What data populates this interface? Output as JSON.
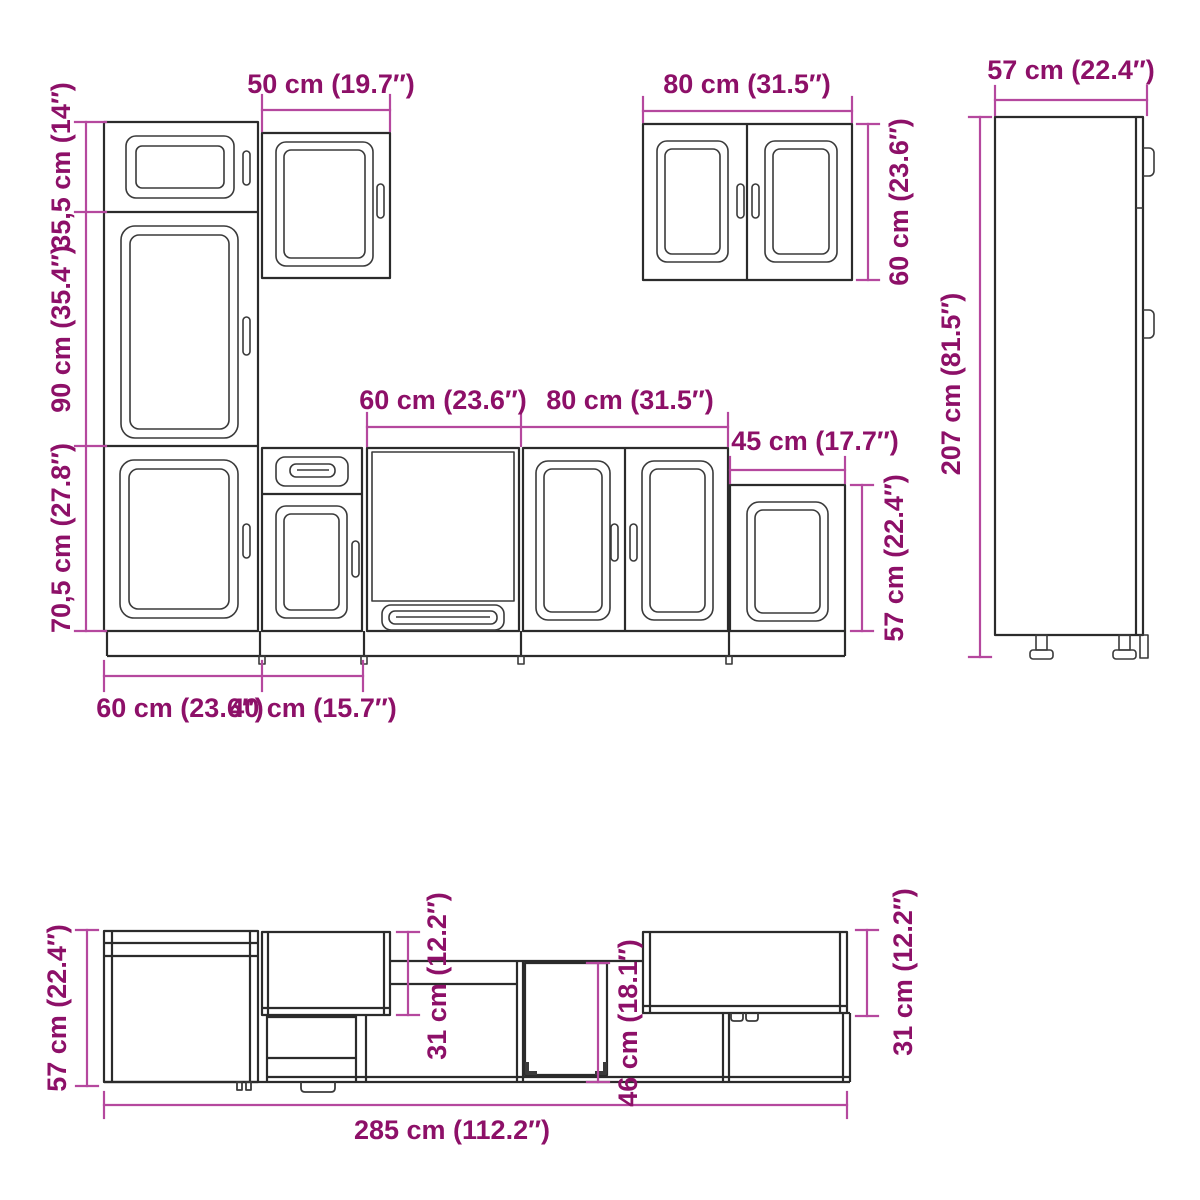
{
  "colors": {
    "outline": "#2b2b2b",
    "detail": "#3a3a3a",
    "dimension": "#b5489e",
    "label": "#8d1068",
    "background": "#ffffff"
  },
  "front_view": {
    "upper_section_height": "35,5 cm (14″)",
    "middle_section_height": "90 cm (35.4″)",
    "base_section_height": "70,5 cm (27.8″)",
    "wall_cabinet_50_width": "50 cm (19.7″)",
    "oven_cabinet_width": "60 cm (23.6″)",
    "base_cabinet_80_width": "80 cm (31.5″)",
    "base_cabinet_45_width": "45 cm (17.7″)",
    "base_cabinet_45_height": "57 cm (22.4″)",
    "wall_cabinet_80_width": "80 cm (31.5″)",
    "wall_cabinet_80_height": "60 cm (23.6″)",
    "tall_cabinet_width": "57 cm (22.4″)",
    "tall_cabinet_height": "207 cm (81.5″)",
    "base_cabinet_60_width": "60 cm (23.6″)",
    "base_cabinet_40_width": "40 cm (15.7″)"
  },
  "plan_view": {
    "cabinet_depth": "57 cm (22.4″)",
    "wall_cabinet_depth_left": "31 cm (12.2″)",
    "recess_depth": "46 cm (18.1″)",
    "wall_cabinet_depth_right": "31 cm (12.2″)",
    "total_width": "285 cm (112.2″)"
  }
}
